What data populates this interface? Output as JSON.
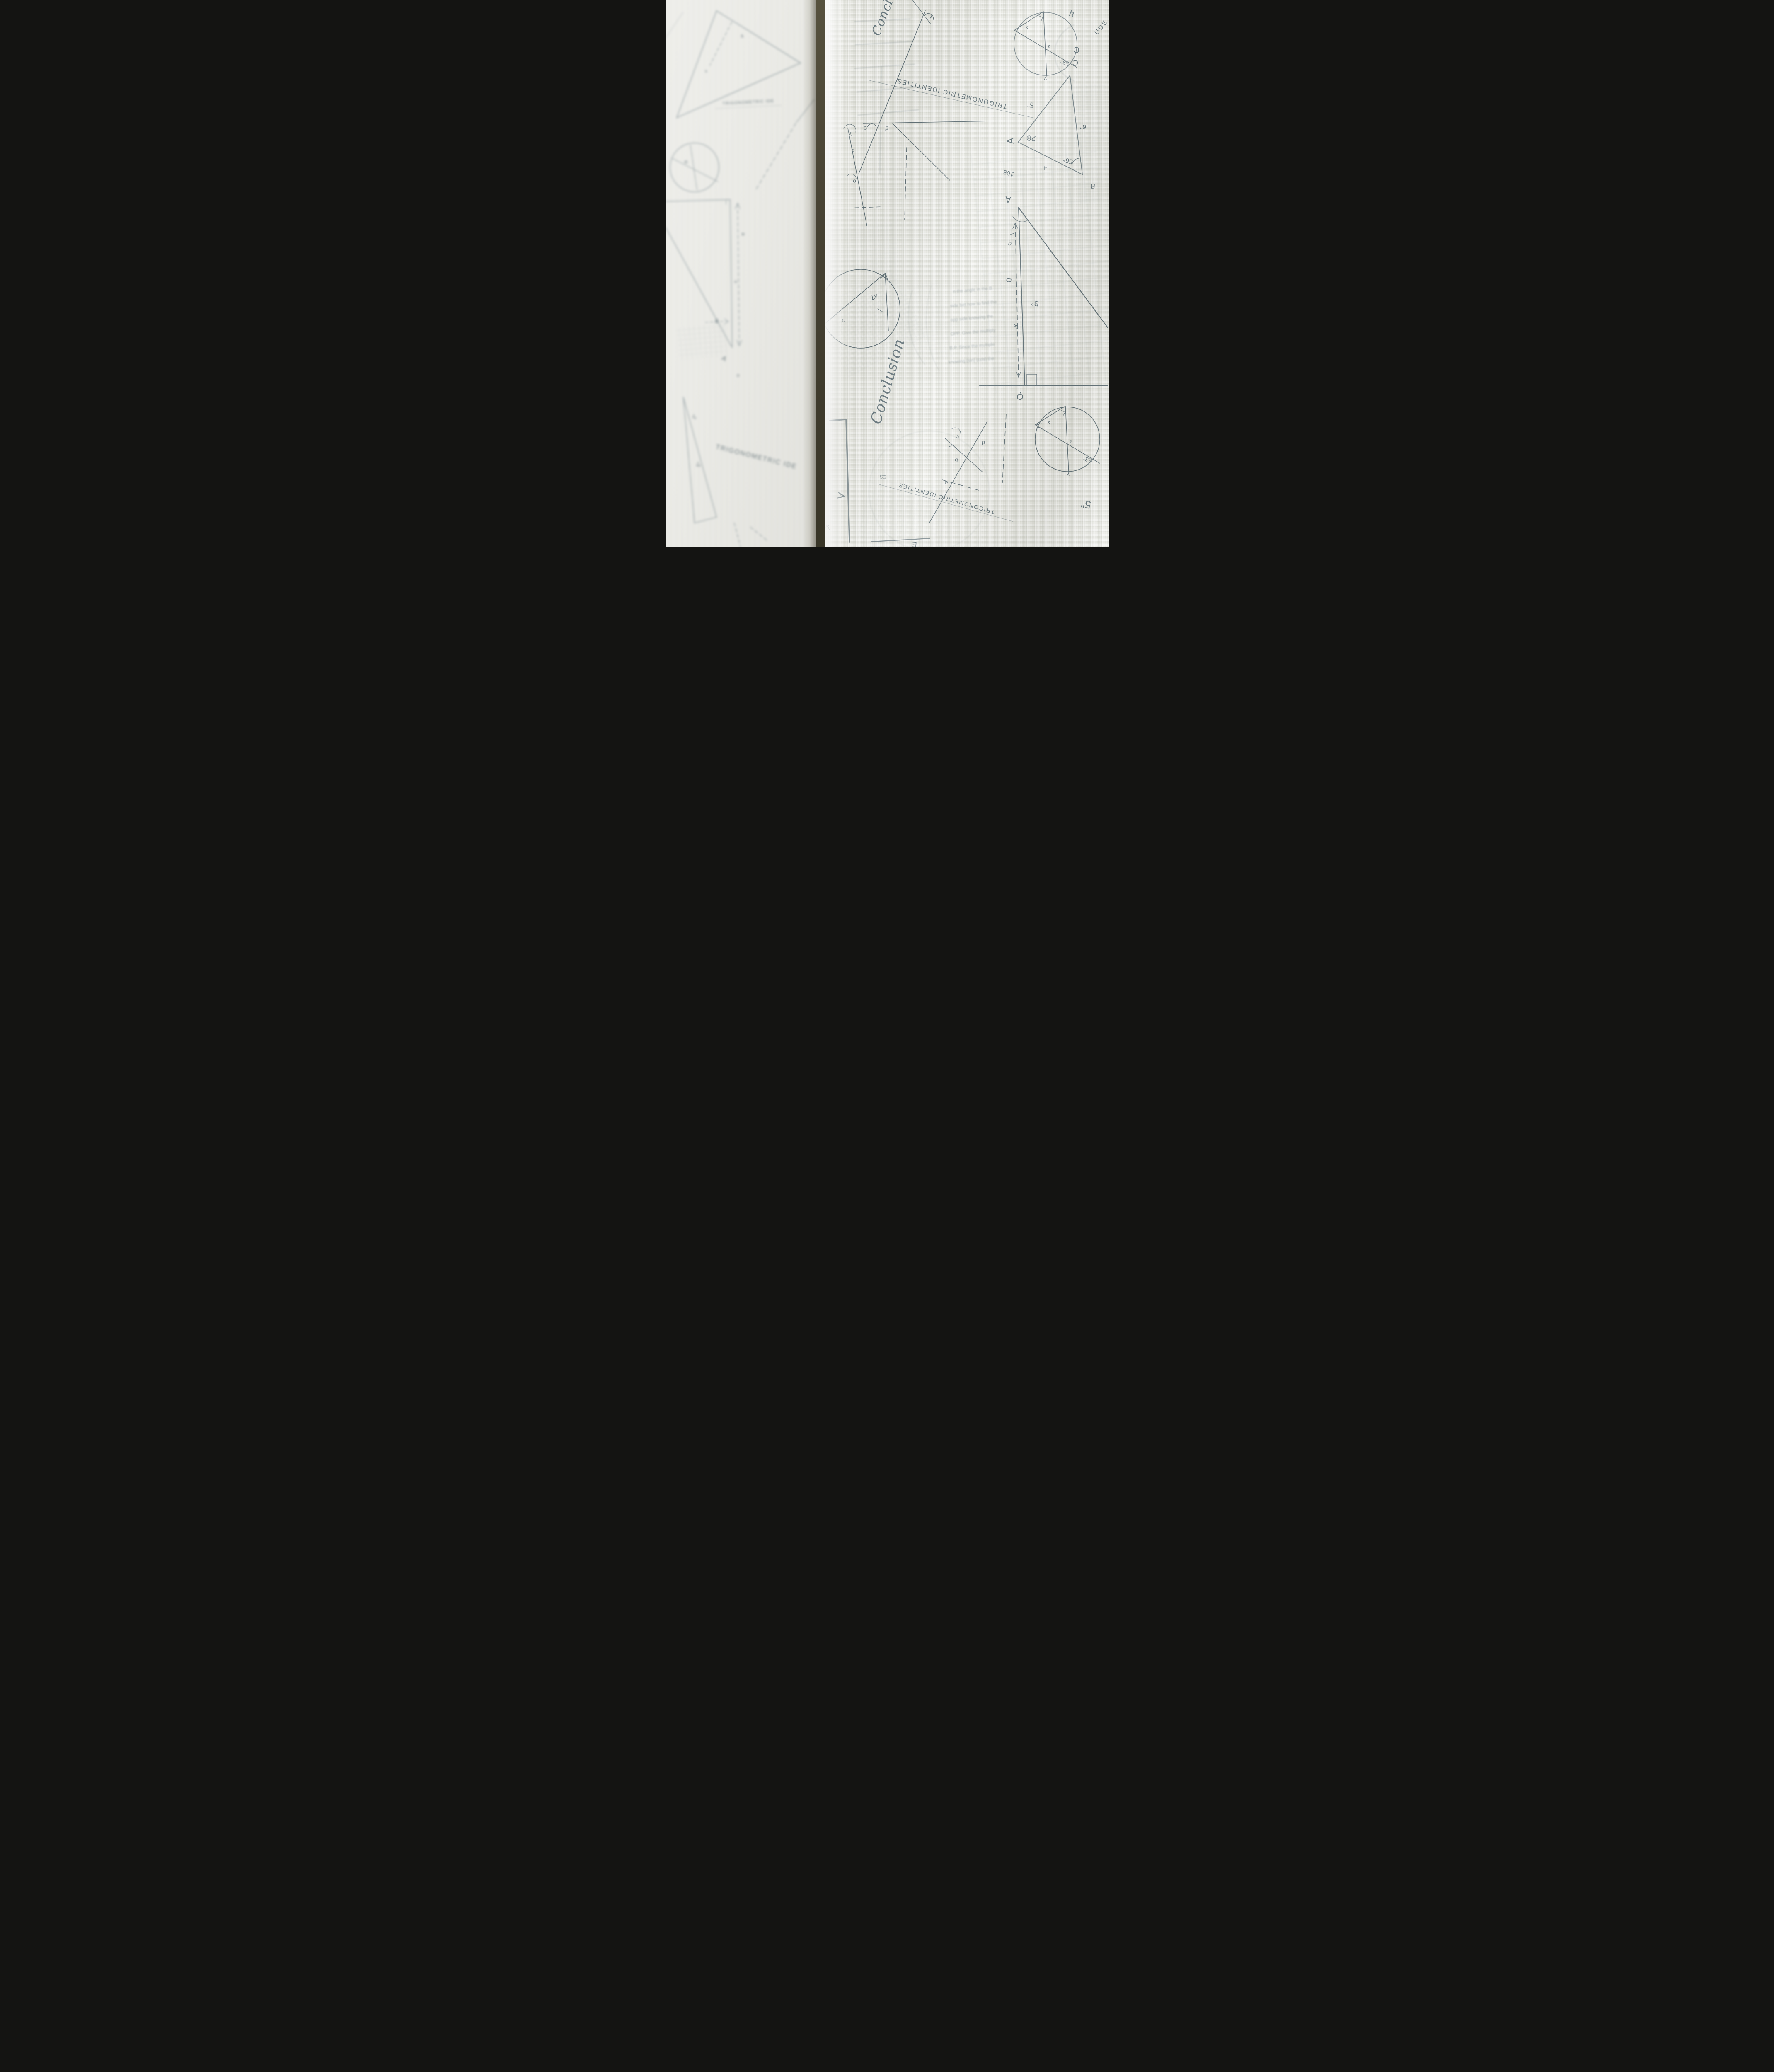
{
  "colors": {
    "gap_background": "#45402f",
    "fabric_right": "#e8e9e3",
    "fabric_left": "#edece7",
    "print_ink": "#5e6e75",
    "print_ink_faint": "#93a0a4",
    "fold_highlight": "#ffffff"
  },
  "right": {
    "trig_top": "TRIGONOMETRIC IDENTITIES",
    "trig_bottom": "TRIGONOMETRIC IDENTITIES",
    "conclusion": "Conclusion",
    "conclusion_top": "Conclu",
    "ude": "UDE",
    "h": "h",
    "c_big": "C",
    "e": "E",
    "x_deg": "x°",
    "a_corner": "A",
    "four": "4",
    "ies": "ES",
    "tri": {
      "a": "A",
      "b": "B",
      "c": "C",
      "a28": "28",
      "a56": "56°",
      "s5": "5\"",
      "s6": "6\"",
      "n108": "108"
    },
    "big_tri": {
      "a": "A",
      "q": "q",
      "b": "B",
      "xp": "x'",
      "bdeg": "B°",
      "qv": "Q"
    },
    "circle47": {
      "a47": "47",
      "z": "z"
    },
    "circle_tr": {
      "x": "x",
      "z": "z",
      "a53": "53°",
      "y": "y"
    },
    "circle_br": {
      "x": "x",
      "z": "z",
      "a53": "53°",
      "y": "y",
      "s5": "5\""
    },
    "angles_top": {
      "c": "c",
      "d": "d",
      "b": "b",
      "o": "o",
      "y": "y",
      "y2": "y"
    },
    "angles_bottom": {
      "a": "a",
      "b": "b",
      "c": "c",
      "d": "d"
    },
    "paragraph": {
      "lines": [
        "n the angle in the B",
        "side bet how to find the",
        "opp side knowing the",
        "OPP. Give the multiply",
        "B.P. Since the multiple",
        "knowing (sin) (cos) the"
      ]
    }
  },
  "left": {
    "trig_small": "TRIGONOMETRIC IDE",
    "trig_bottom": "TRIGONOMETRIC IDE",
    "labels": {
      "a": "A",
      "b": "B",
      "o": "o",
      "o2": "o",
      "a_low": "a",
      "r": "R",
      "x": "x",
      "four": "4",
      "deg5": "5°",
      "len2": "2\""
    }
  }
}
